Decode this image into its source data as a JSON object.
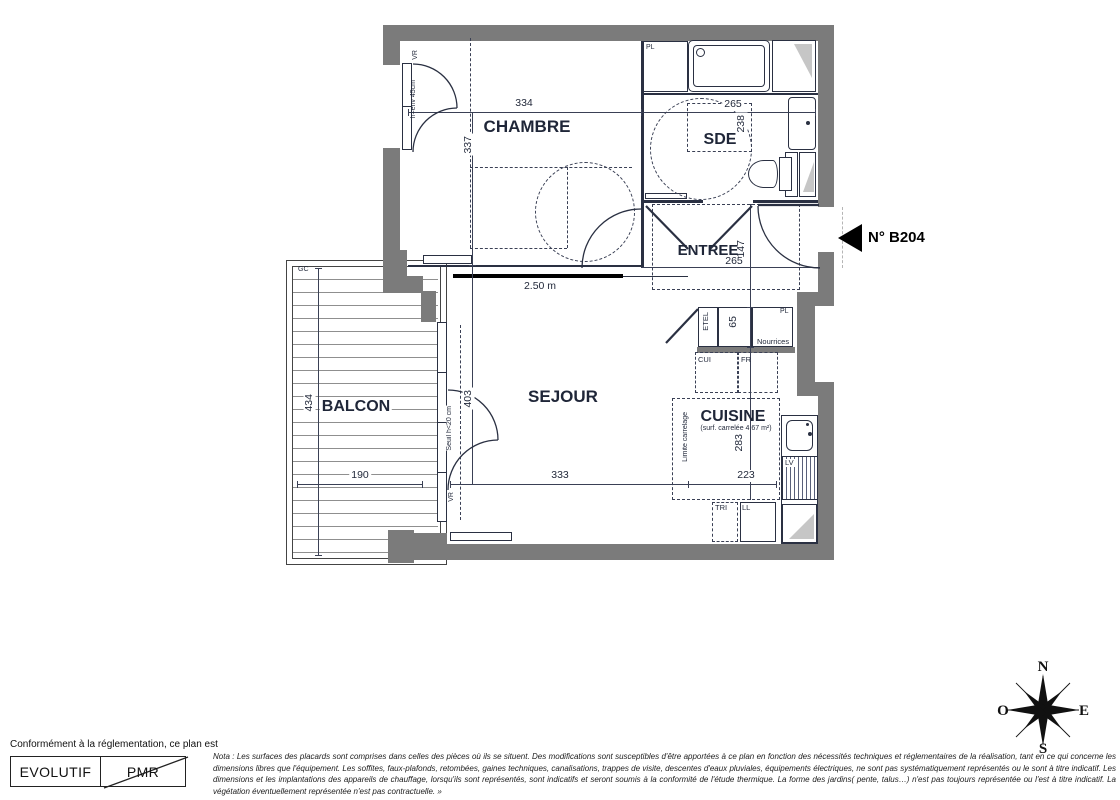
{
  "title_block": {
    "unit_label": "N° B204"
  },
  "rooms": {
    "chambre": "CHAMBRE",
    "sde": "SDE",
    "entree": "ENTREE",
    "sejour": "SEJOUR",
    "cuisine": "CUISINE",
    "cuisine_note": "(surf. carrelée 4.67 m²)",
    "balcon": "BALCON"
  },
  "dims": {
    "chambre_w": "334",
    "chambre_d": "337",
    "sde_w": "265",
    "sde_d": "238",
    "entree_w": "265",
    "entree_d": "147",
    "bay": "2.50 m",
    "sejour_d": "403",
    "sejour_w": "333",
    "balcon_d": "434",
    "balcon_w": "190",
    "cuisine_d": "283",
    "cuisine_w": "223",
    "etel_w": "65"
  },
  "notes": {
    "vr_chambre": "VR",
    "window_h": "h=env 45cm",
    "gc_chambre": "GC",
    "gc_balcon": "GC",
    "pl_sde": "PL",
    "pl_kitchen": "PL",
    "nourrices": "Nourrices",
    "etel": "ETEL",
    "cui": "CUI",
    "fr": "FR",
    "tri": "TRI",
    "ll": "LL",
    "lv": "LV",
    "limite_carrelage": "Limite carrelage",
    "seuil": "Seuil h<20 cm",
    "vr_sejour": "VR"
  },
  "compass": {
    "n": "N",
    "s": "S",
    "e": "E",
    "o": "O"
  },
  "legend": {
    "intro": "Conformément à la réglementation, ce plan est",
    "evolutif": "EVOLUTIF",
    "pmr": "PMR"
  },
  "nota": "Nota : Les surfaces des placards sont comprises dans celles des pièces où ils se situent. Des modifications sont susceptibles d'être apportées à ce plan en fonction des nécessités techniques et réglementaires de la réalisation, tant en ce qui concerne les dimensions libres que l'équipement.  Les soffites, faux-plafonds, retombées, gaines techniques, canalisations, trappes de visite, descentes d'eaux pluviales, équipements électriques, ne sont pas systématiquement représentés ou le sont à titre indicatif. Les dimensions et les implantations des appareils de chauffage, lorsqu'ils sont représentés, sont indicatifs et seront soumis à la conformité de l'étude thermique. La forme des jardins( pente, talus…) n'est pas toujours représentée ou l'est à titre indicatif. La végétation éventuellement représentée n'est pas contractuelle. »"
}
